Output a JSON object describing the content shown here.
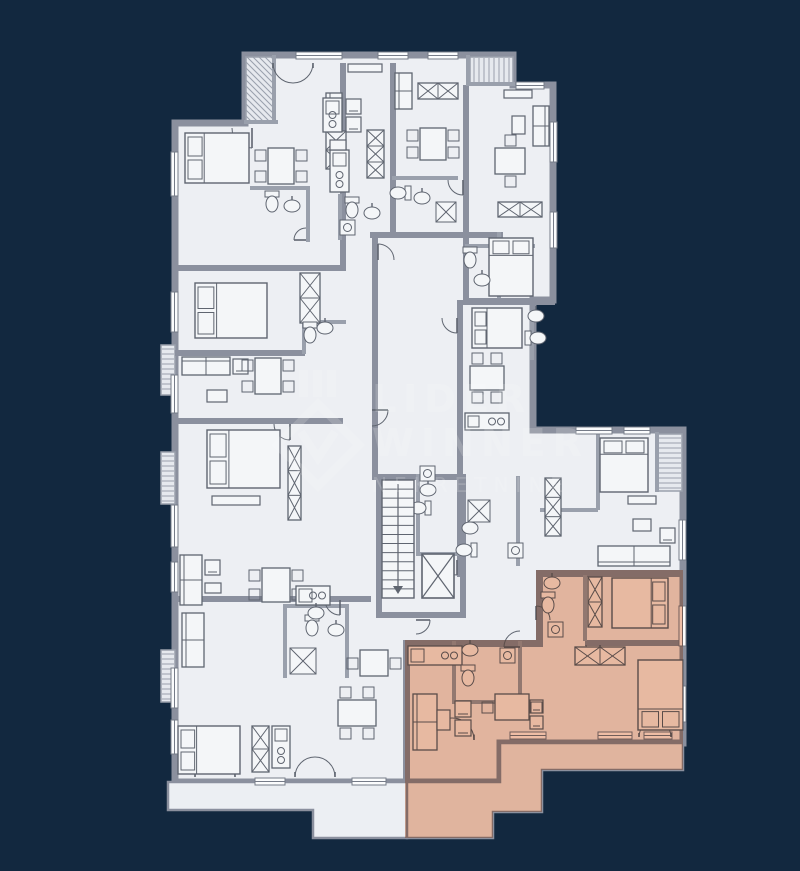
{
  "watermark": {
    "lines": [
      "LIDER",
      "WINNER",
      "NEKRETNINE"
    ],
    "color": "#ffffff",
    "opacity": 0.16
  },
  "palette": {
    "background": "#12283f",
    "floor": "#edeff3",
    "terrace": "#eceff3",
    "balcony_fill": "#e6e9ee",
    "wall": "#8b909e",
    "thin_wall": "#9aa0ac",
    "line": "#5f6570",
    "window_fill": "#fbfcfd",
    "window_line": "#767c88",
    "highlight": "#f2c0a6"
  },
  "floorplan": {
    "canvas": {
      "w": 800,
      "h": 871
    },
    "outline": "245,55 513,55 513,85 553,85 553,300 533,300 533,430 683,430 683,743 500,743 500,782 175,782 175,123 245,123",
    "terraces": [
      {
        "points": "168,782 407,782 407,838 313,838 313,810 168,810"
      },
      {
        "points": "500,743 683,743 683,770 542,770 542,812 493,812 493,838 407,838 407,782 500,782"
      }
    ],
    "highlight": {
      "points": "536,570 683,570 683,770 542,770 542,812 493,812 493,838 405,838 405,640 536,640"
    },
    "walls": [
      [
        340,
        63,
        6,
        207
      ],
      [
        390,
        63,
        6,
        172
      ],
      [
        463,
        85,
        6,
        215
      ],
      [
        175,
        265,
        171,
        6
      ],
      [
        175,
        350,
        130,
        6
      ],
      [
        175,
        418,
        168,
        6
      ],
      [
        175,
        596,
        196,
        6
      ],
      [
        370,
        232,
        133,
        6
      ],
      [
        372,
        238,
        6,
        242
      ],
      [
        457,
        300,
        6,
        136
      ],
      [
        463,
        298,
        92,
        7
      ],
      [
        376,
        474,
        90,
        6
      ],
      [
        376,
        474,
        6,
        142
      ],
      [
        460,
        474,
        6,
        142
      ],
      [
        376,
        612,
        90,
        6
      ],
      [
        457,
        430,
        6,
        147
      ],
      [
        536,
        570,
        150,
        7
      ],
      [
        536,
        570,
        7,
        77
      ],
      [
        403,
        640,
        140,
        7
      ],
      [
        403,
        640,
        7,
        142
      ],
      [
        585,
        640,
        98,
        6
      ]
    ],
    "thin_walls": [
      [
        250,
        186,
        58,
        4
      ],
      [
        306,
        186,
        4,
        56
      ],
      [
        338,
        194,
        4,
        46
      ],
      [
        392,
        176,
        66,
        4
      ],
      [
        465,
        244,
        70,
        4
      ],
      [
        497,
        232,
        4,
        66
      ],
      [
        530,
        310,
        4,
        50
      ],
      [
        416,
        474,
        4,
        80
      ],
      [
        416,
        552,
        46,
        4
      ],
      [
        516,
        476,
        4,
        90
      ],
      [
        452,
        641,
        4,
        62
      ],
      [
        518,
        641,
        4,
        62
      ],
      [
        452,
        700,
        68,
        4
      ],
      [
        596,
        432,
        4,
        78
      ],
      [
        540,
        508,
        58,
        4
      ],
      [
        283,
        604,
        4,
        74
      ],
      [
        345,
        604,
        4,
        74
      ],
      [
        283,
        604,
        64,
        4
      ],
      [
        302,
        320,
        44,
        4
      ],
      [
        302,
        320,
        4,
        34
      ],
      [
        272,
        55,
        4,
        68
      ],
      [
        244,
        120,
        34,
        4
      ],
      [
        466,
        55,
        4,
        30
      ],
      [
        466,
        82,
        49,
        4
      ],
      [
        655,
        432,
        4,
        60
      ],
      [
        583,
        575,
        4,
        66
      ]
    ],
    "windows": [
      [
        296,
        52,
        46,
        7
      ],
      [
        378,
        52,
        30,
        7
      ],
      [
        428,
        52,
        30,
        7
      ],
      [
        516,
        82,
        28,
        7
      ],
      [
        550,
        122,
        7,
        40
      ],
      [
        550,
        212,
        7,
        36
      ],
      [
        171,
        152,
        7,
        44
      ],
      [
        171,
        292,
        7,
        40
      ],
      [
        171,
        375,
        7,
        38
      ],
      [
        171,
        505,
        7,
        42
      ],
      [
        171,
        562,
        7,
        30
      ],
      [
        171,
        668,
        7,
        40
      ],
      [
        171,
        720,
        7,
        34
      ],
      [
        576,
        427,
        36,
        7
      ],
      [
        624,
        427,
        26,
        7
      ],
      [
        679,
        520,
        7,
        40
      ],
      [
        679,
        606,
        7,
        40
      ],
      [
        679,
        686,
        7,
        36
      ],
      [
        510,
        732,
        36,
        7
      ],
      [
        598,
        732,
        34,
        7
      ],
      [
        644,
        732,
        28,
        7
      ],
      [
        255,
        778,
        30,
        7
      ],
      [
        352,
        778,
        34,
        7
      ]
    ],
    "balconies": [
      [
        246,
        57,
        28,
        65,
        "d"
      ],
      [
        470,
        57,
        43,
        27,
        "v"
      ],
      [
        657,
        434,
        25,
        57,
        "h"
      ],
      [
        161,
        345,
        14,
        50,
        "h"
      ],
      [
        161,
        452,
        14,
        52,
        "h"
      ],
      [
        161,
        650,
        14,
        52,
        "h"
      ]
    ],
    "doors": [
      [
        252,
        128,
        20,
        90
      ],
      [
        378,
        260,
        16,
        -90
      ],
      [
        457,
        318,
        15,
        90
      ],
      [
        290,
        424,
        16,
        90
      ],
      [
        340,
        600,
        15,
        90
      ],
      [
        520,
        647,
        16,
        180
      ],
      [
        600,
        645,
        14,
        90
      ],
      [
        536,
        620,
        14,
        -90
      ],
      [
        457,
        560,
        15,
        90
      ],
      [
        463,
        180,
        15,
        90
      ],
      [
        372,
        410,
        16,
        0
      ],
      [
        306,
        240,
        12,
        180
      ],
      [
        416,
        620,
        14,
        0
      ]
    ],
    "double_doors": [
      [
        293,
        63,
        20,
        180
      ],
      [
        215,
        777,
        20,
        0
      ],
      [
        315,
        777,
        20,
        0
      ],
      [
        452,
        740,
        22,
        0
      ],
      [
        655,
        737,
        16,
        0
      ]
    ],
    "furniture": {
      "beds": [
        [
          185,
          133,
          64,
          50,
          "w"
        ],
        [
          195,
          283,
          72,
          55,
          "w"
        ],
        [
          207,
          430,
          73,
          58,
          "w"
        ],
        [
          178,
          726,
          62,
          48,
          "w"
        ],
        [
          489,
          238,
          44,
          58,
          "n"
        ],
        [
          472,
          308,
          50,
          40,
          "w"
        ],
        [
          600,
          438,
          48,
          54,
          "n"
        ],
        [
          612,
          578,
          56,
          50,
          "e"
        ],
        [
          638,
          660,
          45,
          70,
          "s"
        ]
      ],
      "sofas": [
        [
          326,
          93,
          16,
          36,
          "w"
        ],
        [
          533,
          106,
          16,
          40,
          "e"
        ],
        [
          182,
          357,
          48,
          18,
          "n"
        ],
        [
          180,
          555,
          22,
          50,
          "w"
        ],
        [
          182,
          613,
          22,
          54,
          "w"
        ],
        [
          395,
          73,
          17,
          36,
          "w"
        ],
        [
          598,
          546,
          72,
          20,
          "s"
        ],
        [
          413,
          694,
          24,
          56,
          "w"
        ]
      ],
      "armchairs": [
        [
          346,
          99,
          15
        ],
        [
          346,
          117,
          15
        ],
        [
          233,
          359,
          15
        ],
        [
          205,
          560,
          15
        ],
        [
          660,
          528,
          15
        ],
        [
          455,
          701,
          16
        ],
        [
          455,
          720,
          16
        ],
        [
          530,
          700,
          13
        ],
        [
          530,
          716,
          13
        ]
      ],
      "tables": [
        [
          268,
          148,
          26,
          36,
          "lr"
        ],
        [
          420,
          128,
          26,
          32,
          "lr"
        ],
        [
          495,
          148,
          30,
          26,
          "tb"
        ],
        [
          255,
          358,
          26,
          36,
          "lr"
        ],
        [
          470,
          366,
          34,
          24,
          "tb"
        ],
        [
          262,
          568,
          28,
          34,
          "lr"
        ],
        [
          360,
          650,
          28,
          26,
          "lr"
        ],
        [
          338,
          700,
          38,
          26,
          "tb"
        ],
        [
          495,
          694,
          34,
          26,
          "lr"
        ]
      ],
      "wardrobes": [
        [
          326,
          131,
          20,
          38,
          2
        ],
        [
          367,
          130,
          17,
          48,
          3
        ],
        [
          300,
          273,
          20,
          50,
          2
        ],
        [
          288,
          446,
          13,
          74,
          3
        ],
        [
          498,
          202,
          44,
          15,
          2
        ],
        [
          545,
          478,
          16,
          58,
          3
        ],
        [
          588,
          577,
          14,
          50,
          2
        ],
        [
          575,
          647,
          50,
          18,
          2
        ],
        [
          252,
          726,
          17,
          46,
          2
        ],
        [
          418,
          83,
          40,
          16,
          2
        ]
      ],
      "kitchens": [
        [
          323,
          98,
          19,
          34,
          "v"
        ],
        [
          330,
          150,
          19,
          42,
          "v"
        ],
        [
          296,
          586,
          34,
          19,
          "h"
        ],
        [
          272,
          726,
          18,
          42,
          "v"
        ],
        [
          465,
          413,
          44,
          17,
          "h"
        ],
        [
          408,
          646,
          54,
          19,
          "h"
        ]
      ],
      "toilets": [
        [
          272,
          202,
          0
        ],
        [
          352,
          208,
          0
        ],
        [
          400,
          193,
          90
        ],
        [
          470,
          258,
          0
        ],
        [
          536,
          338,
          270
        ],
        [
          312,
          626,
          0
        ],
        [
          420,
          508,
          90
        ],
        [
          466,
          550,
          90
        ],
        [
          548,
          603,
          0
        ],
        [
          468,
          676,
          0
        ],
        [
          310,
          333,
          0
        ]
      ],
      "sinks": [
        [
          292,
          206
        ],
        [
          372,
          213
        ],
        [
          422,
          198
        ],
        [
          482,
          280
        ],
        [
          536,
          316
        ],
        [
          336,
          630
        ],
        [
          316,
          613
        ],
        [
          428,
          490
        ],
        [
          470,
          528
        ],
        [
          552,
          583
        ],
        [
          470,
          650
        ],
        [
          325,
          328
        ]
      ],
      "washers": [
        [
          340,
          220
        ],
        [
          420,
          466
        ],
        [
          508,
          543
        ],
        [
          548,
          622
        ],
        [
          500,
          648
        ]
      ],
      "showers": [
        [
          290,
          648,
          26
        ],
        [
          468,
          500,
          22
        ],
        [
          436,
          202,
          20
        ]
      ],
      "shelves": [
        [
          348,
          64,
          34,
          8
        ],
        [
          504,
          90,
          28,
          8
        ],
        [
          628,
          496,
          28,
          8
        ],
        [
          212,
          496,
          48,
          9
        ],
        [
          330,
          140,
          16,
          10
        ],
        [
          512,
          116,
          13,
          18
        ],
        [
          207,
          390,
          20,
          12
        ],
        [
          437,
          710,
          13,
          20
        ],
        [
          633,
          519,
          18,
          12
        ],
        [
          205,
          583,
          16,
          10
        ]
      ],
      "stairs": [
        382,
        480,
        32,
        118,
        13
      ],
      "elevator": [
        422,
        554,
        32,
        44
      ]
    }
  }
}
